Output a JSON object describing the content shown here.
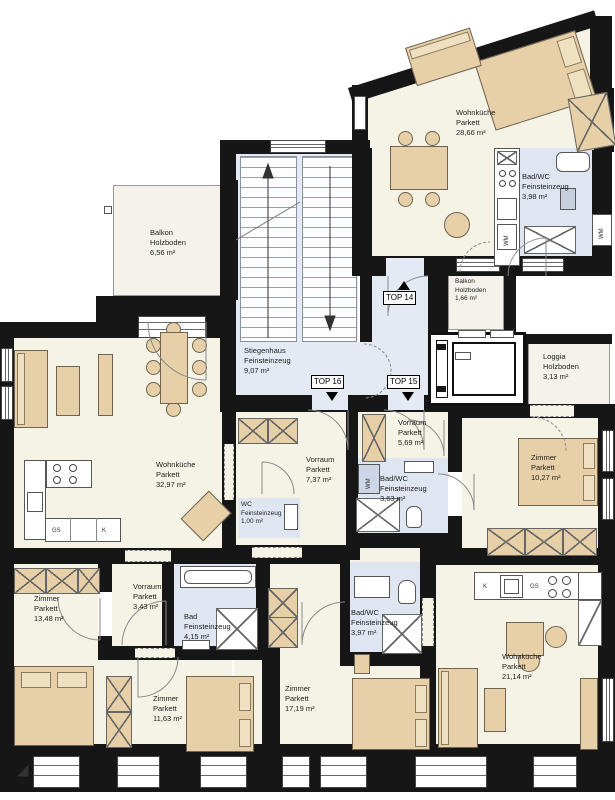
{
  "plan": {
    "colors": {
      "wall": "#161616",
      "room": "#f5f2e6",
      "bathroom": "#dfe5f1",
      "stairwell": "#e4e9f3",
      "furniture": "#e7d0a8",
      "balcony": "#f4f2eb"
    },
    "units": {
      "t14": "TOP 14",
      "t15": "TOP 15",
      "t16": "TOP 16"
    },
    "rooms": {
      "wk28": {
        "name": "Wohnküche",
        "floor": "Parkett",
        "area": "28,66 m²"
      },
      "bad398": {
        "name": "Bad/WC",
        "floor": "Feinsteinzeug",
        "area": "3,98 m²"
      },
      "balkon656": {
        "name": "Balkon",
        "floor": "Holzboden",
        "area": "6,56 m²"
      },
      "balkon166": {
        "name": "Balkon",
        "floor": "Holzboden",
        "area": "1,66 m²"
      },
      "loggia313": {
        "name": "Loggia",
        "floor": "Holzboden",
        "area": "3,13 m²"
      },
      "stiegenhaus": {
        "name": "Stiegenhaus",
        "floor": "Feinsteinzeug",
        "area": "9,07 m²"
      },
      "wk3297": {
        "name": "Wohnküche",
        "floor": "Parkett",
        "area": "32,97 m²"
      },
      "vorraum737": {
        "name": "Vorraum",
        "floor": "Parkett",
        "area": "7,37 m²"
      },
      "wc100": {
        "name": "WC",
        "floor": "Feinsteinzeug",
        "area": "1,00 m²"
      },
      "vorraum569": {
        "name": "Vorraum",
        "floor": "Parkett",
        "area": "5,69 m²"
      },
      "bad363": {
        "name": "Bad/WC",
        "floor": "Feinsteinzeug",
        "area": "3,63 m²"
      },
      "zi1027": {
        "name": "Zimmer",
        "floor": "Parkett",
        "area": "10,27 m²"
      },
      "zi1348": {
        "name": "Zimmer",
        "floor": "Parkett",
        "area": "13,48 m²"
      },
      "vorraum343": {
        "name": "Vorraum",
        "floor": "Parkett",
        "area": "3,43 m²"
      },
      "bad415": {
        "name": "Bad",
        "floor": "Feinsteinzeug",
        "area": "4,15 m²"
      },
      "zi1163": {
        "name": "Zimmer",
        "floor": "Parkett",
        "area": "11,63 m²"
      },
      "zi1719": {
        "name": "Zimmer",
        "floor": "Parkett",
        "area": "17,19 m²"
      },
      "wk2114": {
        "name": "Wohnküche",
        "floor": "Parkett",
        "area": "21,14 m²"
      }
    },
    "appliances": {
      "wm": "WM",
      "gs": "GS",
      "k": "K"
    }
  }
}
